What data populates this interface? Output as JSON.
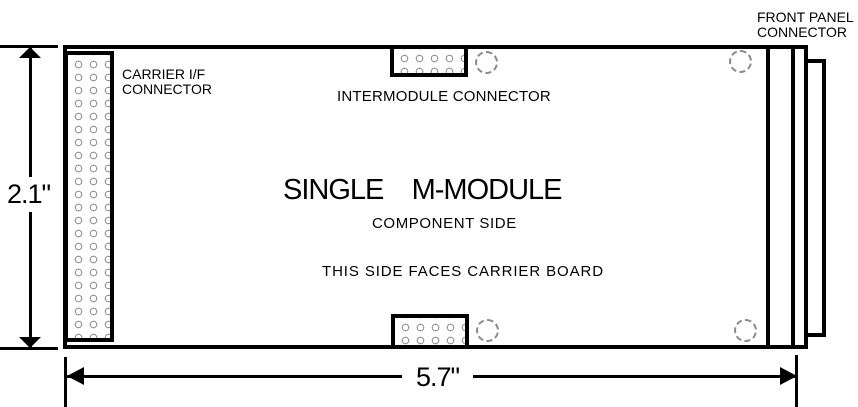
{
  "diagram": {
    "board_title": "SINGLE    M-MODULE",
    "board_subtitle": "COMPONENT SIDE",
    "board_note": "THIS SIDE FACES CARRIER BOARD",
    "labels": {
      "carrier_if_line1": "CARRIER I/F",
      "carrier_if_line2": "CONNECTOR",
      "intermodule": "INTERMODULE CONNECTOR",
      "front_panel_line1": "FRONT PANEL",
      "front_panel_line2": "CONNECTOR"
    },
    "dimensions": {
      "height_label": "2.1\"",
      "width_label": "5.7\""
    },
    "colors": {
      "line": "#000000",
      "background": "#ffffff",
      "stipple": "#9a9a9a",
      "hole_dash": "#8a8a8a"
    }
  }
}
